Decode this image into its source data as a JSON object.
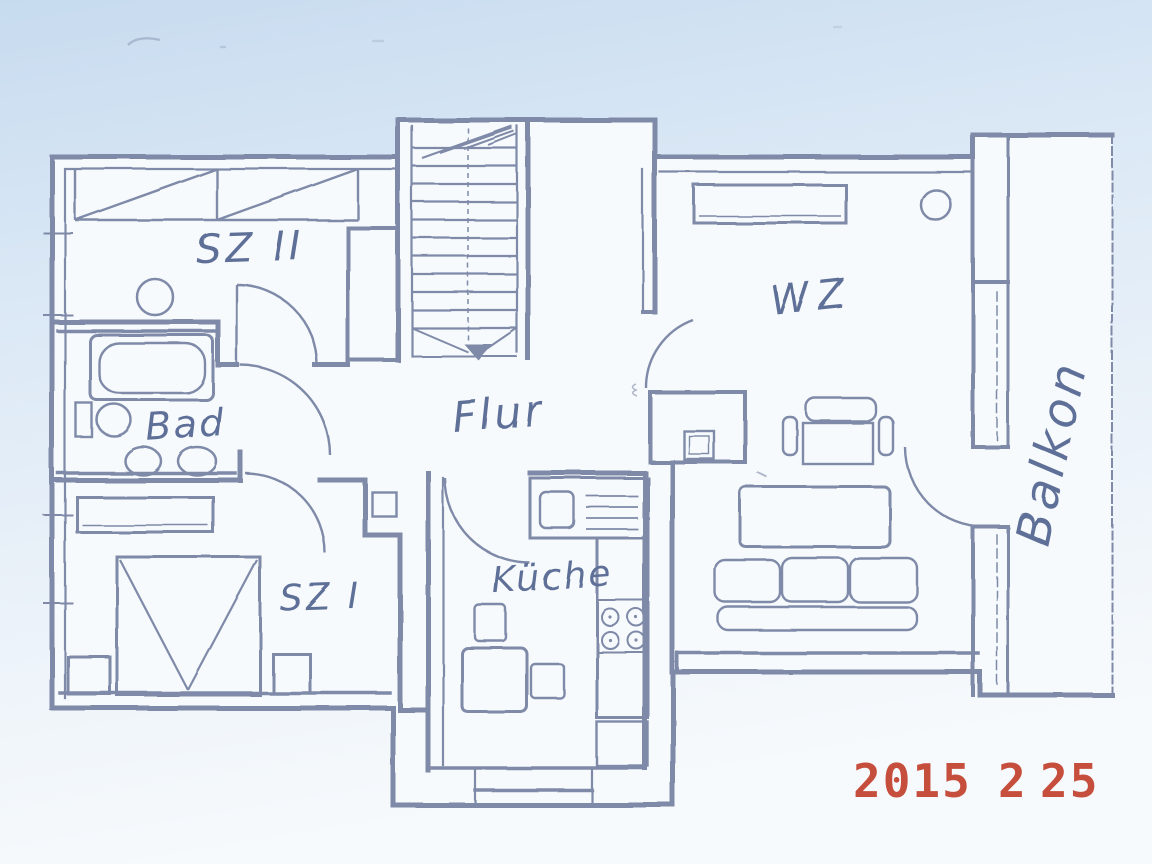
{
  "colors": {
    "wall_line": "#7e8aa8",
    "label_ink": "#5f7098",
    "stamp_red": "#c2402c",
    "paper_tint_top": "#c9ddf0",
    "paper_tint_bottom": "#f6f9fc",
    "room_interior": "#f7fafc"
  },
  "floor_plan": {
    "rooms": [
      {
        "id": "sz2",
        "label": "SZ II"
      },
      {
        "id": "bad",
        "label": "Bad"
      },
      {
        "id": "flur",
        "label": "Flur"
      },
      {
        "id": "wz",
        "label": "WZ"
      },
      {
        "id": "sz1",
        "label": "SZ I"
      },
      {
        "id": "kueche",
        "label": "Küche"
      },
      {
        "id": "balkon",
        "label": "Balkon"
      }
    ],
    "features": [
      "staircase",
      "roof-slope-hatch",
      "bathtub",
      "toilet",
      "twin-wash-basins",
      "double-bed",
      "wardrobe",
      "nightstand",
      "sofa",
      "coffee-table",
      "armchair",
      "sideboard",
      "tv",
      "kitchen-sink",
      "stove",
      "kitchen-table",
      "chairs",
      "balcony-door",
      "windows"
    ]
  },
  "stamp": {
    "year": "2015",
    "month": "2",
    "day": "25"
  }
}
